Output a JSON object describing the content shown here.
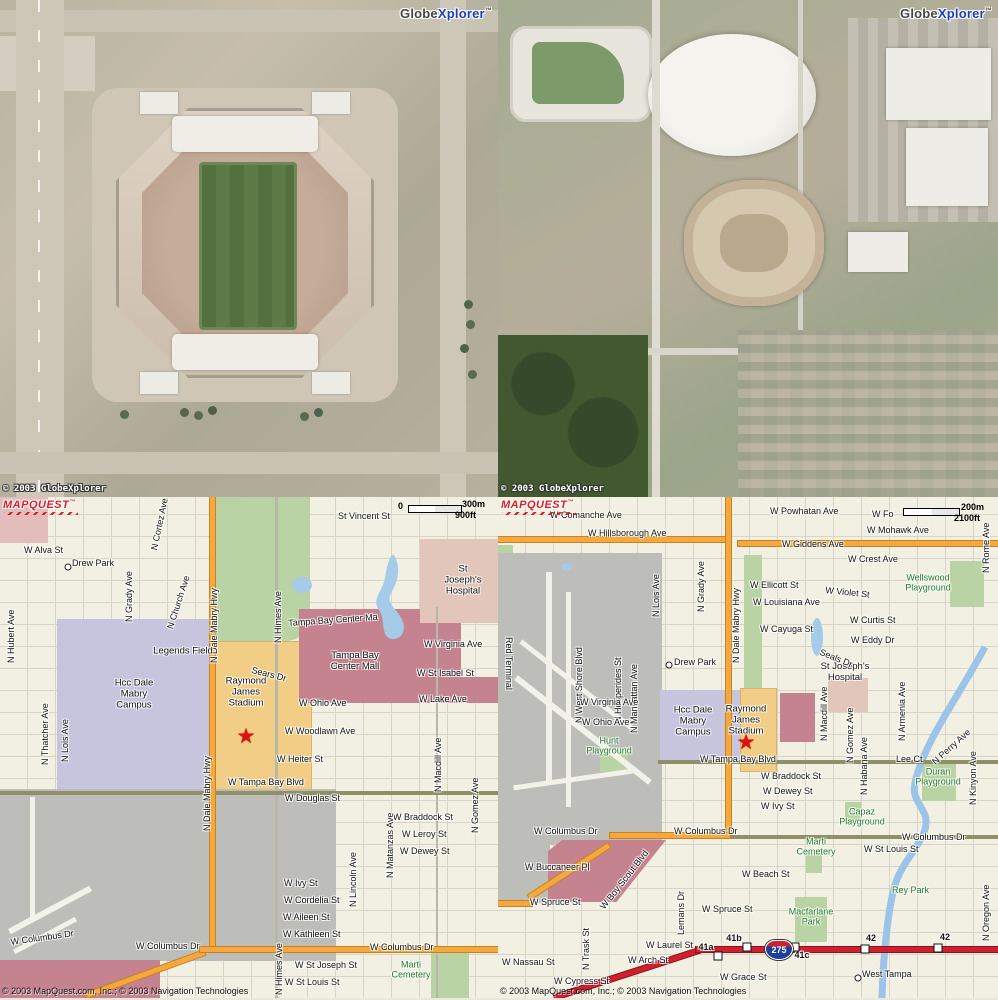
{
  "branding": {
    "globexplorer": {
      "part1": "Globe",
      "part2": "Xplorer",
      "tm": "™"
    },
    "globexplorer_copyright": "© 2003 GlobeXplorer",
    "mapquest_logo": "MAPQUEST",
    "mapquest_tm": "™",
    "map_copyright": "© 2003 MapQuest.com, Inc.; © 2003 Navigation Technologies"
  },
  "colors": {
    "road_orange": "#f4a83f",
    "interstate_red": "#cf2030",
    "water_blue": "#a6cbe9",
    "park_green": "#b9d3a4",
    "park_text_green": "#207a2a",
    "campus_purple": "#c7c4de",
    "stadium_orange": "#f2cd86",
    "mall_maroon": "#c4838f",
    "hospital_pink": "#e2c6ba",
    "airport_gray": "#bdbdb9",
    "map_bg": "#f1f0e2",
    "logo_red": "#e01b22",
    "star_red": "#e01010"
  },
  "left_map": {
    "scale": {
      "zero": "0",
      "metric": "300m",
      "imperial": "900ft"
    },
    "labels": [
      {
        "t": "St Vincent St",
        "x": 338,
        "y": 14
      },
      {
        "t": "W Alva St",
        "x": 24,
        "y": 48
      },
      {
        "t": "Drew Park",
        "x": 72,
        "y": 61
      },
      {
        "t": "",
        "cls": "dot",
        "x": 68,
        "y": 70
      },
      {
        "t": "N Cortez Ave",
        "x": 149,
        "y": 52,
        "r": -78
      },
      {
        "t": "N Grady Ave",
        "x": 124,
        "y": 125,
        "r": -90
      },
      {
        "t": "N Church Ave",
        "x": 165,
        "y": 130,
        "r": -72
      },
      {
        "t": "N Dale Mabry Hwy",
        "x": 209,
        "y": 166,
        "r": -90
      },
      {
        "t": "N Himes Ave",
        "x": 273,
        "y": 146,
        "r": -90
      },
      {
        "t": "N Hubert Ave",
        "x": 6,
        "y": 166,
        "r": -90
      },
      {
        "t": "N Thatcher Ave",
        "x": 40,
        "y": 268,
        "r": -90
      },
      {
        "t": "N Lois Ave",
        "x": 60,
        "y": 265,
        "r": -90
      },
      {
        "t": "Legends Field",
        "x": 183,
        "y": 155,
        "cls": "poi"
      },
      {
        "t": "Hcc Dale\nMabry\nCampus",
        "x": 134,
        "y": 198,
        "cls": "poi"
      },
      {
        "t": "Raymond\nJames\nStadium",
        "x": 246,
        "y": 196,
        "cls": "poi"
      },
      {
        "t": "★",
        "x": 246,
        "y": 240,
        "cls": "star"
      },
      {
        "t": "Sears Dr",
        "x": 253,
        "y": 168,
        "r": 14
      },
      {
        "t": "St Joseph's\nHospital",
        "x": 463,
        "y": 84,
        "cls": "poi"
      },
      {
        "t": "Tampa Bay Center Ma",
        "x": 288,
        "y": 121,
        "r": -4
      },
      {
        "t": "Tampa Bay\nCenter Mall",
        "x": 355,
        "y": 165,
        "cls": "poi"
      },
      {
        "t": "W Virginia Ave",
        "x": 424,
        "y": 142
      },
      {
        "t": "W St Isabel St",
        "x": 417,
        "y": 171
      },
      {
        "t": "W Lake Ave",
        "x": 419,
        "y": 197
      },
      {
        "t": "W Ohio Ave",
        "x": 299,
        "y": 201
      },
      {
        "t": "W Woodlawn Ave",
        "x": 285,
        "y": 229
      },
      {
        "t": "W Heiter St",
        "x": 277,
        "y": 257
      },
      {
        "t": "W Tampa Bay Blvd",
        "x": 228,
        "y": 280
      },
      {
        "t": "W Douglas St",
        "x": 285,
        "y": 296
      },
      {
        "t": "W Braddock St",
        "x": 393,
        "y": 315
      },
      {
        "t": "W Leroy St",
        "x": 402,
        "y": 332
      },
      {
        "t": "W Dewey St",
        "x": 400,
        "y": 349
      },
      {
        "t": "W Ivy St",
        "x": 284,
        "y": 381
      },
      {
        "t": "W Cordelia St",
        "x": 284,
        "y": 398
      },
      {
        "t": "W Aileen St",
        "x": 283,
        "y": 415
      },
      {
        "t": "W Kathleen St",
        "x": 283,
        "y": 432
      },
      {
        "t": "W Columbus Dr",
        "x": 370,
        "y": 445
      },
      {
        "t": "W St Joseph St",
        "x": 295,
        "y": 463
      },
      {
        "t": "W St Louis St",
        "x": 285,
        "y": 480
      },
      {
        "t": "Marti\nCemetery",
        "x": 411,
        "y": 473,
        "cls": "pk"
      },
      {
        "t": "N Lincoln Ave",
        "x": 348,
        "y": 410,
        "r": -90
      },
      {
        "t": "N Matanzas Ave",
        "x": 385,
        "y": 381,
        "r": -90
      },
      {
        "t": "N Macdill Ave",
        "x": 433,
        "y": 295,
        "r": -90
      },
      {
        "t": "N Gomez Ave",
        "x": 470,
        "y": 336,
        "r": -90
      },
      {
        "t": "N Himes Ave",
        "x": 274,
        "y": 498,
        "r": -90
      },
      {
        "t": "N Dale Mabry Hwy",
        "x": 202,
        "y": 334,
        "r": -90
      },
      {
        "t": "W Columbus Dr",
        "x": 10,
        "y": 440,
        "r": -8
      },
      {
        "t": "W Columbus Dr",
        "x": 136,
        "y": 444
      }
    ]
  },
  "right_map": {
    "scale": {
      "metric": "200m",
      "imperial": "2100ft"
    },
    "shield": "275",
    "labels": [
      {
        "t": "W Comanche Ave",
        "x": 52,
        "y": 13
      },
      {
        "t": "W Hillsborough Ave",
        "x": 90,
        "y": 31
      },
      {
        "t": "W Powhatan Ave",
        "x": 272,
        "y": 9
      },
      {
        "t": "W Fo",
        "x": 374,
        "y": 12
      },
      {
        "t": "W Mohawk Ave",
        "x": 369,
        "y": 28
      },
      {
        "t": "W Giddens Ave",
        "x": 284,
        "y": 42
      },
      {
        "t": "W Crest Ave",
        "x": 350,
        "y": 57
      },
      {
        "t": "Wellswood\nPlayground",
        "x": 430,
        "y": 86,
        "cls": "pk"
      },
      {
        "t": "W Ellicott St",
        "x": 252,
        "y": 83
      },
      {
        "t": "W Violet St",
        "x": 328,
        "y": 88,
        "r": 6
      },
      {
        "t": "W Louisiana Ave",
        "x": 255,
        "y": 100
      },
      {
        "t": "W Cayuga St",
        "x": 262,
        "y": 127
      },
      {
        "t": "W Curtis St",
        "x": 352,
        "y": 118
      },
      {
        "t": "W Eddy Dr",
        "x": 353,
        "y": 138
      },
      {
        "t": "St Joseph's\nHospital",
        "x": 347,
        "y": 176,
        "cls": "poi"
      },
      {
        "t": "Seals Dr",
        "x": 324,
        "y": 150,
        "r": 22
      },
      {
        "t": "N West Shore Blvd",
        "x": 76,
        "y": 226,
        "r": -90
      },
      {
        "t": "N Hesperides St",
        "x": 115,
        "y": 226,
        "r": -90
      },
      {
        "t": "N Manhattan Ave",
        "x": 131,
        "y": 236,
        "r": -90
      },
      {
        "t": "N Lois Ave",
        "x": 153,
        "y": 120,
        "r": -90
      },
      {
        "t": "N Grady Ave",
        "x": 198,
        "y": 115,
        "r": -90
      },
      {
        "t": "N Dale Mabry Hwy",
        "x": 233,
        "y": 166,
        "r": -90
      },
      {
        "t": "Drew Park",
        "x": 176,
        "y": 160
      },
      {
        "t": "",
        "cls": "dot",
        "x": 171,
        "y": 168
      },
      {
        "t": "W Virginia Ave",
        "x": 82,
        "y": 200
      },
      {
        "t": "W Ohio Ave",
        "x": 84,
        "y": 220
      },
      {
        "t": "Hunt\nPlayground",
        "x": 111,
        "y": 249,
        "cls": "pk"
      },
      {
        "t": "Hcc Dale\nMabry\nCampus",
        "x": 195,
        "y": 225,
        "cls": "poi"
      },
      {
        "t": "Raymond\nJames\nStadium",
        "x": 248,
        "y": 224,
        "cls": "poi"
      },
      {
        "t": "★",
        "x": 248,
        "y": 246,
        "cls": "star"
      },
      {
        "t": "W Tampa Bay Blvd",
        "x": 202,
        "y": 257
      },
      {
        "t": "W Braddock St",
        "x": 263,
        "y": 274
      },
      {
        "t": "W Dewey St",
        "x": 265,
        "y": 289
      },
      {
        "t": "W Ivy St",
        "x": 263,
        "y": 304
      },
      {
        "t": "Capaz\nPlayground",
        "x": 364,
        "y": 320,
        "cls": "pk"
      },
      {
        "t": "W Columbus Dr",
        "x": 36,
        "y": 329
      },
      {
        "t": "W Columbus Dr",
        "x": 176,
        "y": 329
      },
      {
        "t": "W Columbus Dr",
        "x": 404,
        "y": 335
      },
      {
        "t": "Marti\nCemetery",
        "x": 318,
        "y": 350,
        "cls": "pk"
      },
      {
        "t": "W St Louis St",
        "x": 366,
        "y": 347
      },
      {
        "t": "W Beach St",
        "x": 244,
        "y": 372
      },
      {
        "t": "Rey Park",
        "x": 394,
        "y": 388,
        "cls": "pk1"
      },
      {
        "t": "W Buccaneer Pl",
        "x": 27,
        "y": 365
      },
      {
        "t": "W Boy Scout Blvd",
        "x": 100,
        "y": 408,
        "r": -52
      },
      {
        "t": "W Spruce St",
        "x": 32,
        "y": 400
      },
      {
        "t": "W Spruce St",
        "x": 204,
        "y": 407
      },
      {
        "t": "Lemans Dr",
        "x": 178,
        "y": 438,
        "r": -90
      },
      {
        "t": "N Trask St",
        "x": 83,
        "y": 473,
        "r": -90
      },
      {
        "t": "W Laurel St",
        "x": 148,
        "y": 443
      },
      {
        "t": "W Arch St",
        "x": 130,
        "y": 458
      },
      {
        "t": "W Nassau St",
        "x": 4,
        "y": 460
      },
      {
        "t": "W Cypress St",
        "x": 56,
        "y": 479
      },
      {
        "t": "W Grace St",
        "x": 222,
        "y": 475
      },
      {
        "t": "West Tampa",
        "x": 364,
        "y": 472
      },
      {
        "t": "",
        "cls": "dot",
        "x": 360,
        "y": 481
      },
      {
        "t": "41a",
        "x": 208,
        "y": 450,
        "cls": "ex"
      },
      {
        "t": "41b",
        "x": 236,
        "y": 441,
        "cls": "ex"
      },
      {
        "t": "41c",
        "x": 304,
        "y": 458,
        "cls": "ex"
      },
      {
        "t": "42",
        "x": 373,
        "y": 441,
        "cls": "ex"
      },
      {
        "t": "42",
        "x": 447,
        "y": 440,
        "cls": "ex"
      },
      {
        "t": "",
        "cls": "sq",
        "x": 220,
        "y": 459
      },
      {
        "t": "",
        "cls": "sq",
        "x": 249,
        "y": 450
      },
      {
        "t": "",
        "cls": "sq",
        "x": 297,
        "y": 450
      },
      {
        "t": "",
        "cls": "sq",
        "x": 367,
        "y": 452
      },
      {
        "t": "",
        "cls": "sq",
        "x": 440,
        "y": 451
      },
      {
        "t": "Macfarlane\nPark",
        "x": 313,
        "y": 420,
        "cls": "pk"
      },
      {
        "t": "N Oregon Ave",
        "x": 483,
        "y": 444,
        "r": -90
      },
      {
        "t": "N Rome Ave",
        "x": 483,
        "y": 76,
        "r": -90
      },
      {
        "t": "N Kinyon Ave",
        "x": 470,
        "y": 308,
        "r": -90
      },
      {
        "t": "N Perry Ave",
        "x": 432,
        "y": 262,
        "r": -42
      },
      {
        "t": "Duran\nPlayground",
        "x": 440,
        "y": 280,
        "cls": "pk"
      },
      {
        "t": "Lee Ct",
        "x": 398,
        "y": 257
      },
      {
        "t": "N Habana Ave",
        "x": 361,
        "y": 298,
        "r": -90
      },
      {
        "t": "N Gomez Ave",
        "x": 347,
        "y": 266,
        "r": -90
      },
      {
        "t": "N Macdill Ave",
        "x": 321,
        "y": 244,
        "r": -90
      },
      {
        "t": "N Armenia Ave",
        "x": 399,
        "y": 244,
        "r": -90
      },
      {
        "t": "Red Terminal",
        "x": 16,
        "y": 140,
        "r": 90
      }
    ]
  }
}
